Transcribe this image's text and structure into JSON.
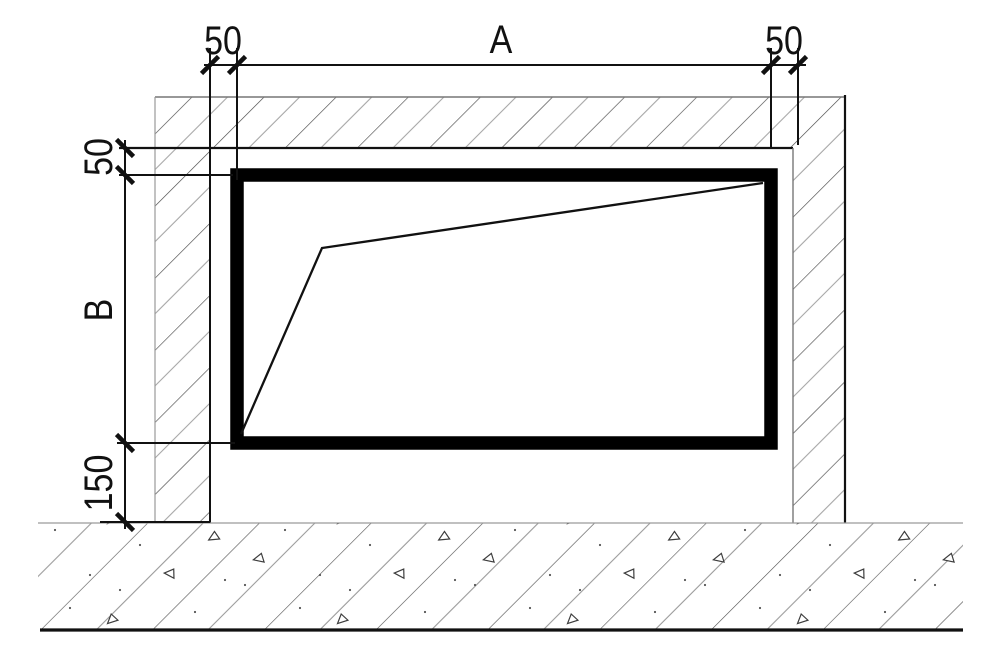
{
  "dimensions": {
    "top_left": "50",
    "top_span": "A",
    "top_right": "50",
    "left_top": "50",
    "left_span": "B",
    "left_bottom": "150"
  },
  "colors": {
    "ink": "#111111",
    "frame": "#000000",
    "light_line": "#9a9a9a",
    "wall_hatch_dark": "#4a4a4a",
    "wall_hatch_light": "#a6a6a6",
    "floor_hatch_dark": "#4f4f4f",
    "floor_hatch_light": "#9a9a9a",
    "background": "#ffffff"
  }
}
